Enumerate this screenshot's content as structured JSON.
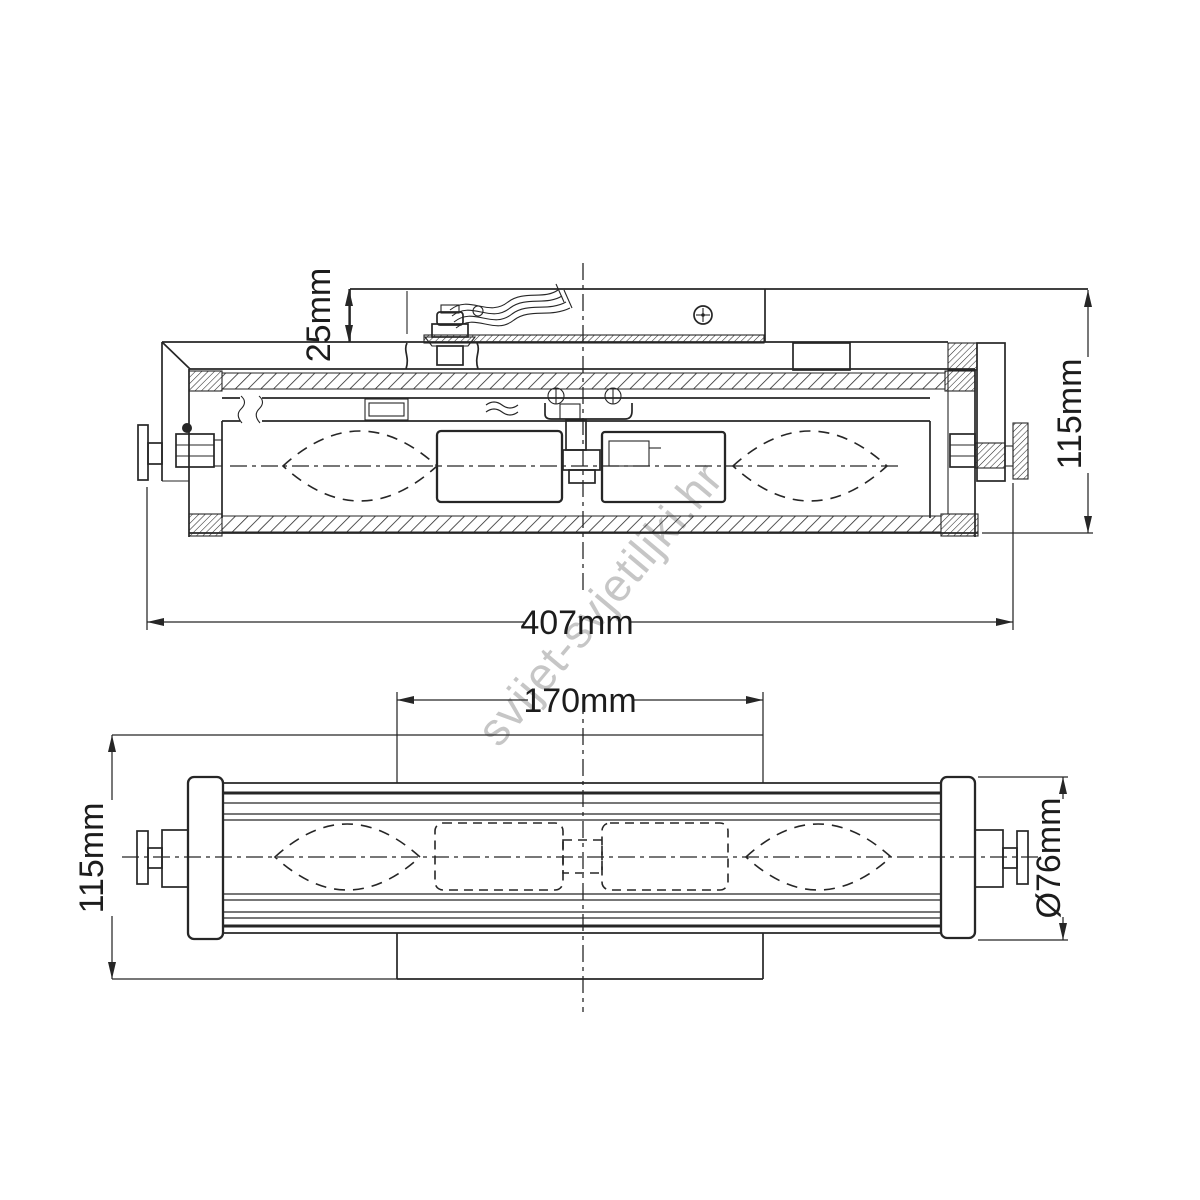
{
  "watermark": {
    "text": "svijet-svjetiljki.hr",
    "color": "#c6c6c6"
  },
  "colors": {
    "line": "#262626",
    "background": "#ffffff"
  },
  "side_view": {
    "dim_bracket_depth": "25mm",
    "dim_overall_height": "115mm",
    "dim_overall_width": "407mm"
  },
  "front_view": {
    "dim_backplate_width": "170mm",
    "dim_overall_height": "115mm",
    "dim_glass_diameter": "Ø76mm"
  }
}
